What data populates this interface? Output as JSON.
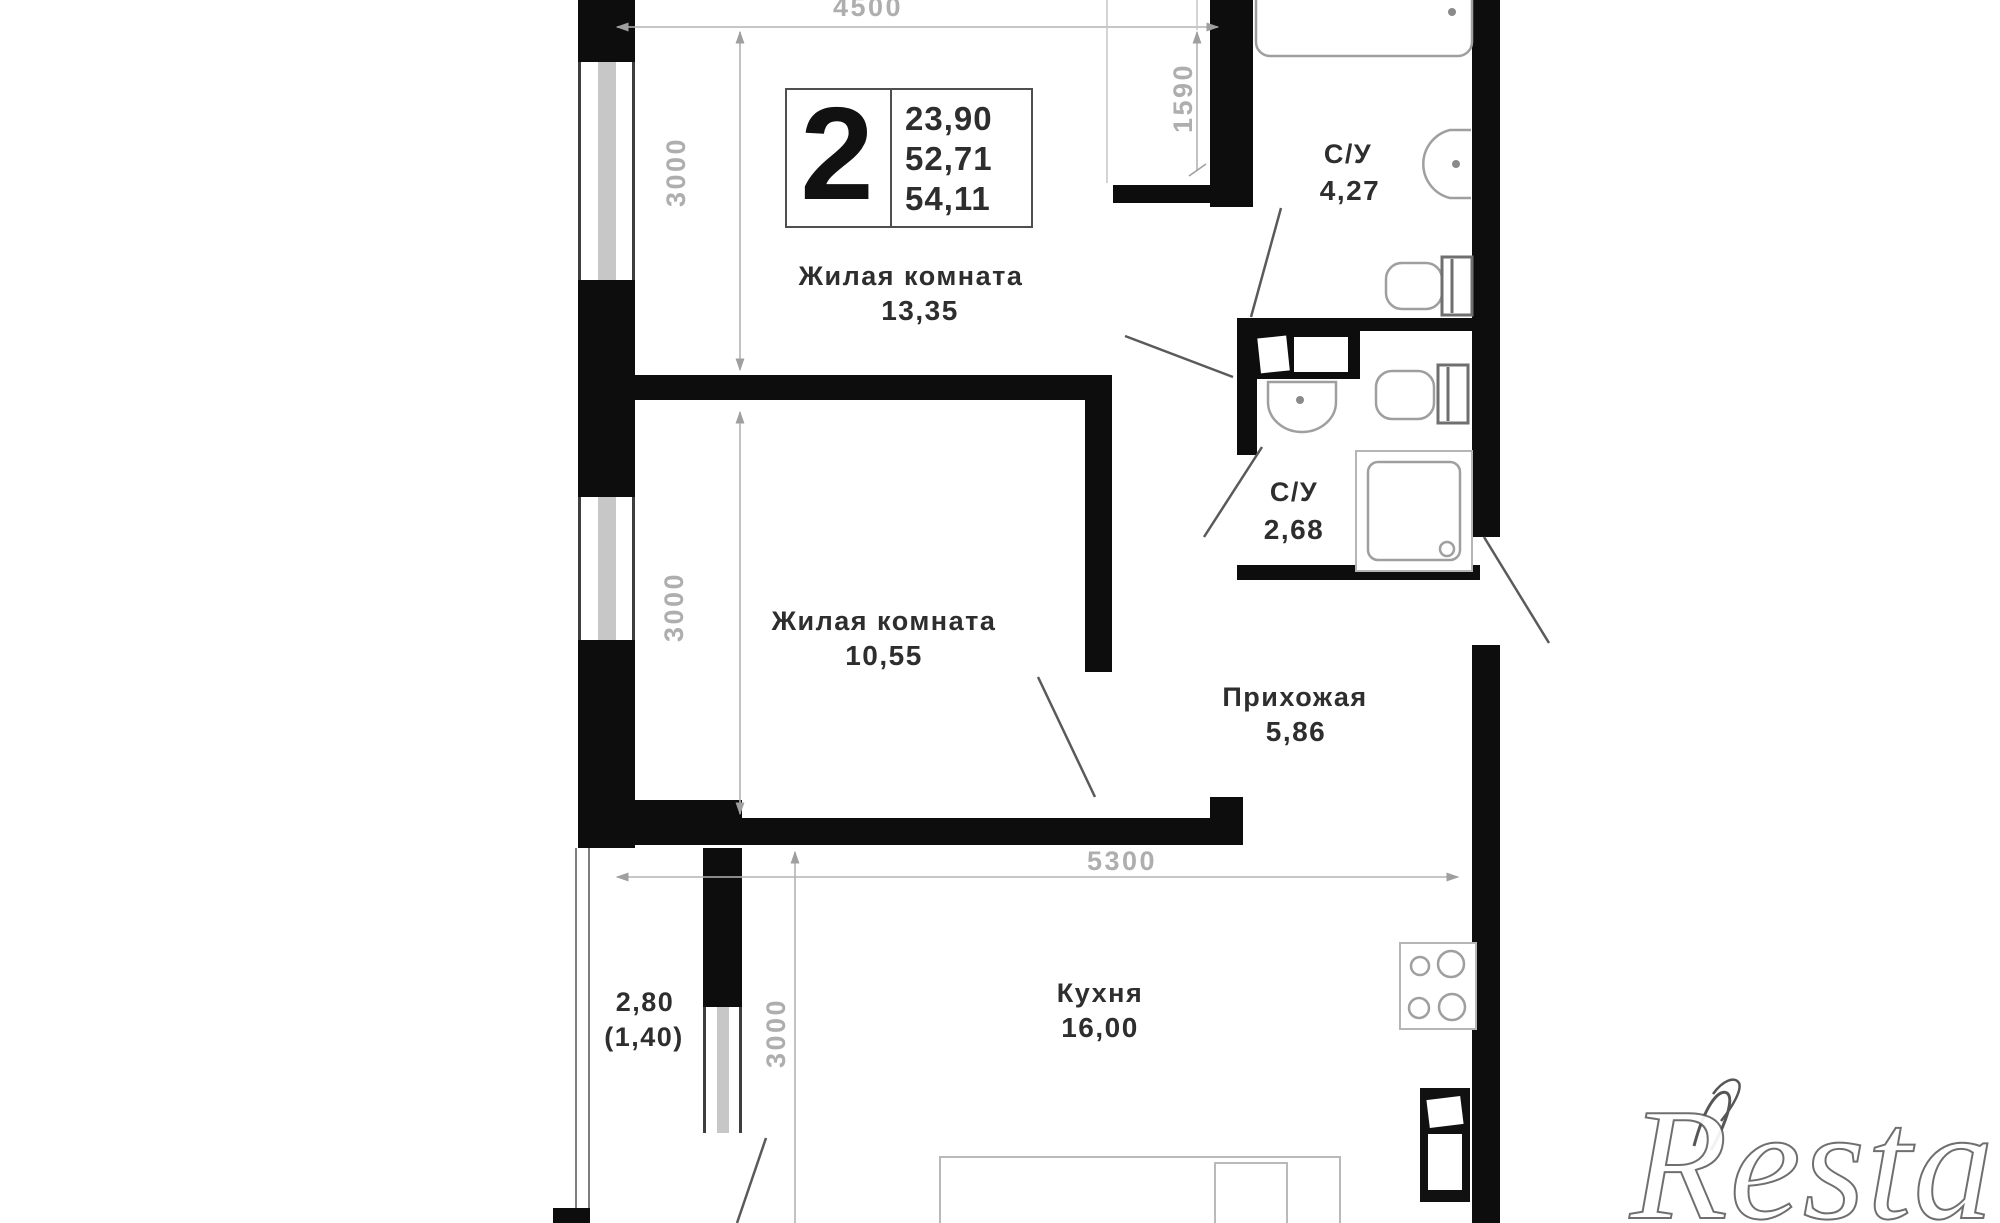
{
  "unit_card": {
    "rooms_count": "2",
    "values": [
      "23,90",
      "52,71",
      "54,11"
    ]
  },
  "labels": {
    "room1_name": "Жилая комната",
    "room1_area": "13,35",
    "room2_name": "Жилая комната",
    "room2_area": "10,55",
    "kitchen_name": "Кухня",
    "kitchen_area": "16,00",
    "hallway_name": "Прихожая",
    "hallway_area": "5,86",
    "bathroom1_name": "С/У",
    "bathroom1_area": "4,27",
    "bathroom2_name": "С/У",
    "bathroom2_area": "2,68",
    "balcony_line1": "2,80",
    "balcony_line2": "(1,40)"
  },
  "dimensions": {
    "room1_width": "4500",
    "alcove_depth": "1590",
    "room1_height": "3000",
    "room2_height": "3000",
    "kitchen_width": "5300",
    "kitchen_height": "3000"
  },
  "watermark": "Restate"
}
